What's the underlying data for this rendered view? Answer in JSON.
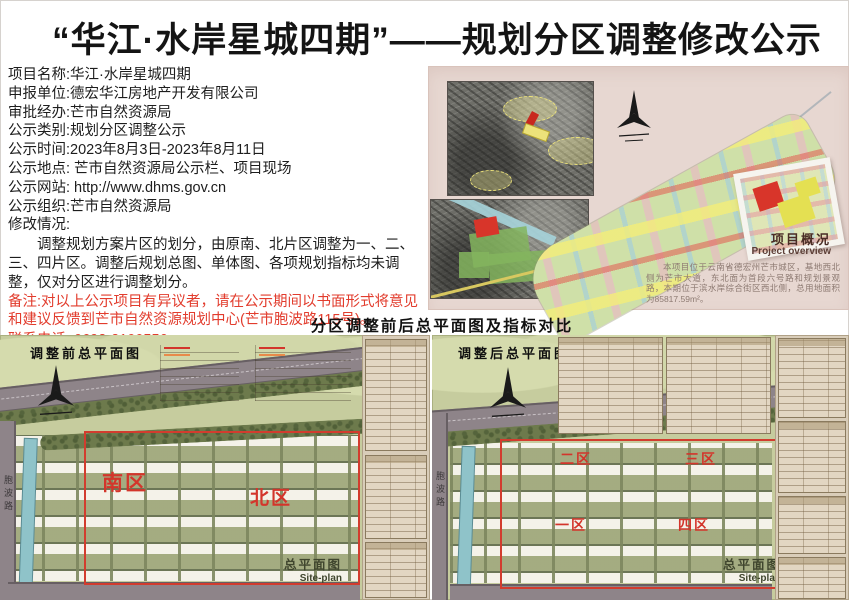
{
  "title": "“华江·水岸星城四期”——规划分区调整修改公示",
  "info": {
    "lines": [
      "项目名称:华江·水岸星城四期",
      "申报单位:德宏华江房地产开发有限公司",
      "审批经办:芒市自然资源局",
      "公示类别:规划分区调整公示",
      "公示时间:2023年8月3日-2023年8月11日",
      "公示地点: 芒市自然资源局公示栏、项目现场",
      "公示网站: http://www.dhms.gov.cn",
      "公示组织:芒市自然资源局",
      "修改情况:"
    ],
    "modification_detail": "调整规划方案片区的划分，由原南、北片区调整为一、二、三、四片区。调整后规划总图、单体图、各项规划指标均未调整，仅对分区进行调整划分。",
    "remark": "备注:对以上公示项目有异议者，请在公示期间以书面形式将意见和建议反馈到芒市自然资源规划中心(芒市胞波路115号)。",
    "phone": "联系电话: 0692-2100556"
  },
  "overview": {
    "heading": "项目概况",
    "heading_en": "Project overview",
    "description": "本项目位于云南省德宏州芒市城区，基地西北侧为芒市大道，东北面为首段六号路和规划景观路，本期位于滨水岸综合街区西北侧，总用地面积为85817.59m²。"
  },
  "caption": "分区调整前后总平面图及指标对比",
  "plans": {
    "before": {
      "title": "调整前总平面图",
      "zones": [
        "南区",
        "北区"
      ],
      "footer": "总平面图",
      "footer_en": "Site-plan",
      "road_label": "胞波路"
    },
    "after": {
      "title": "调整后总平面图",
      "zones": [
        "一区",
        "二区",
        "三区",
        "四区"
      ],
      "footer": "总平面图",
      "footer_en": "Site-plan",
      "road_label": "胞波路"
    }
  },
  "colors": {
    "accent_red": "#e23c2d",
    "zone_red": "#d3352b",
    "panel_pink": "#e7d7d1",
    "plan_green": "#c6cc9e"
  }
}
